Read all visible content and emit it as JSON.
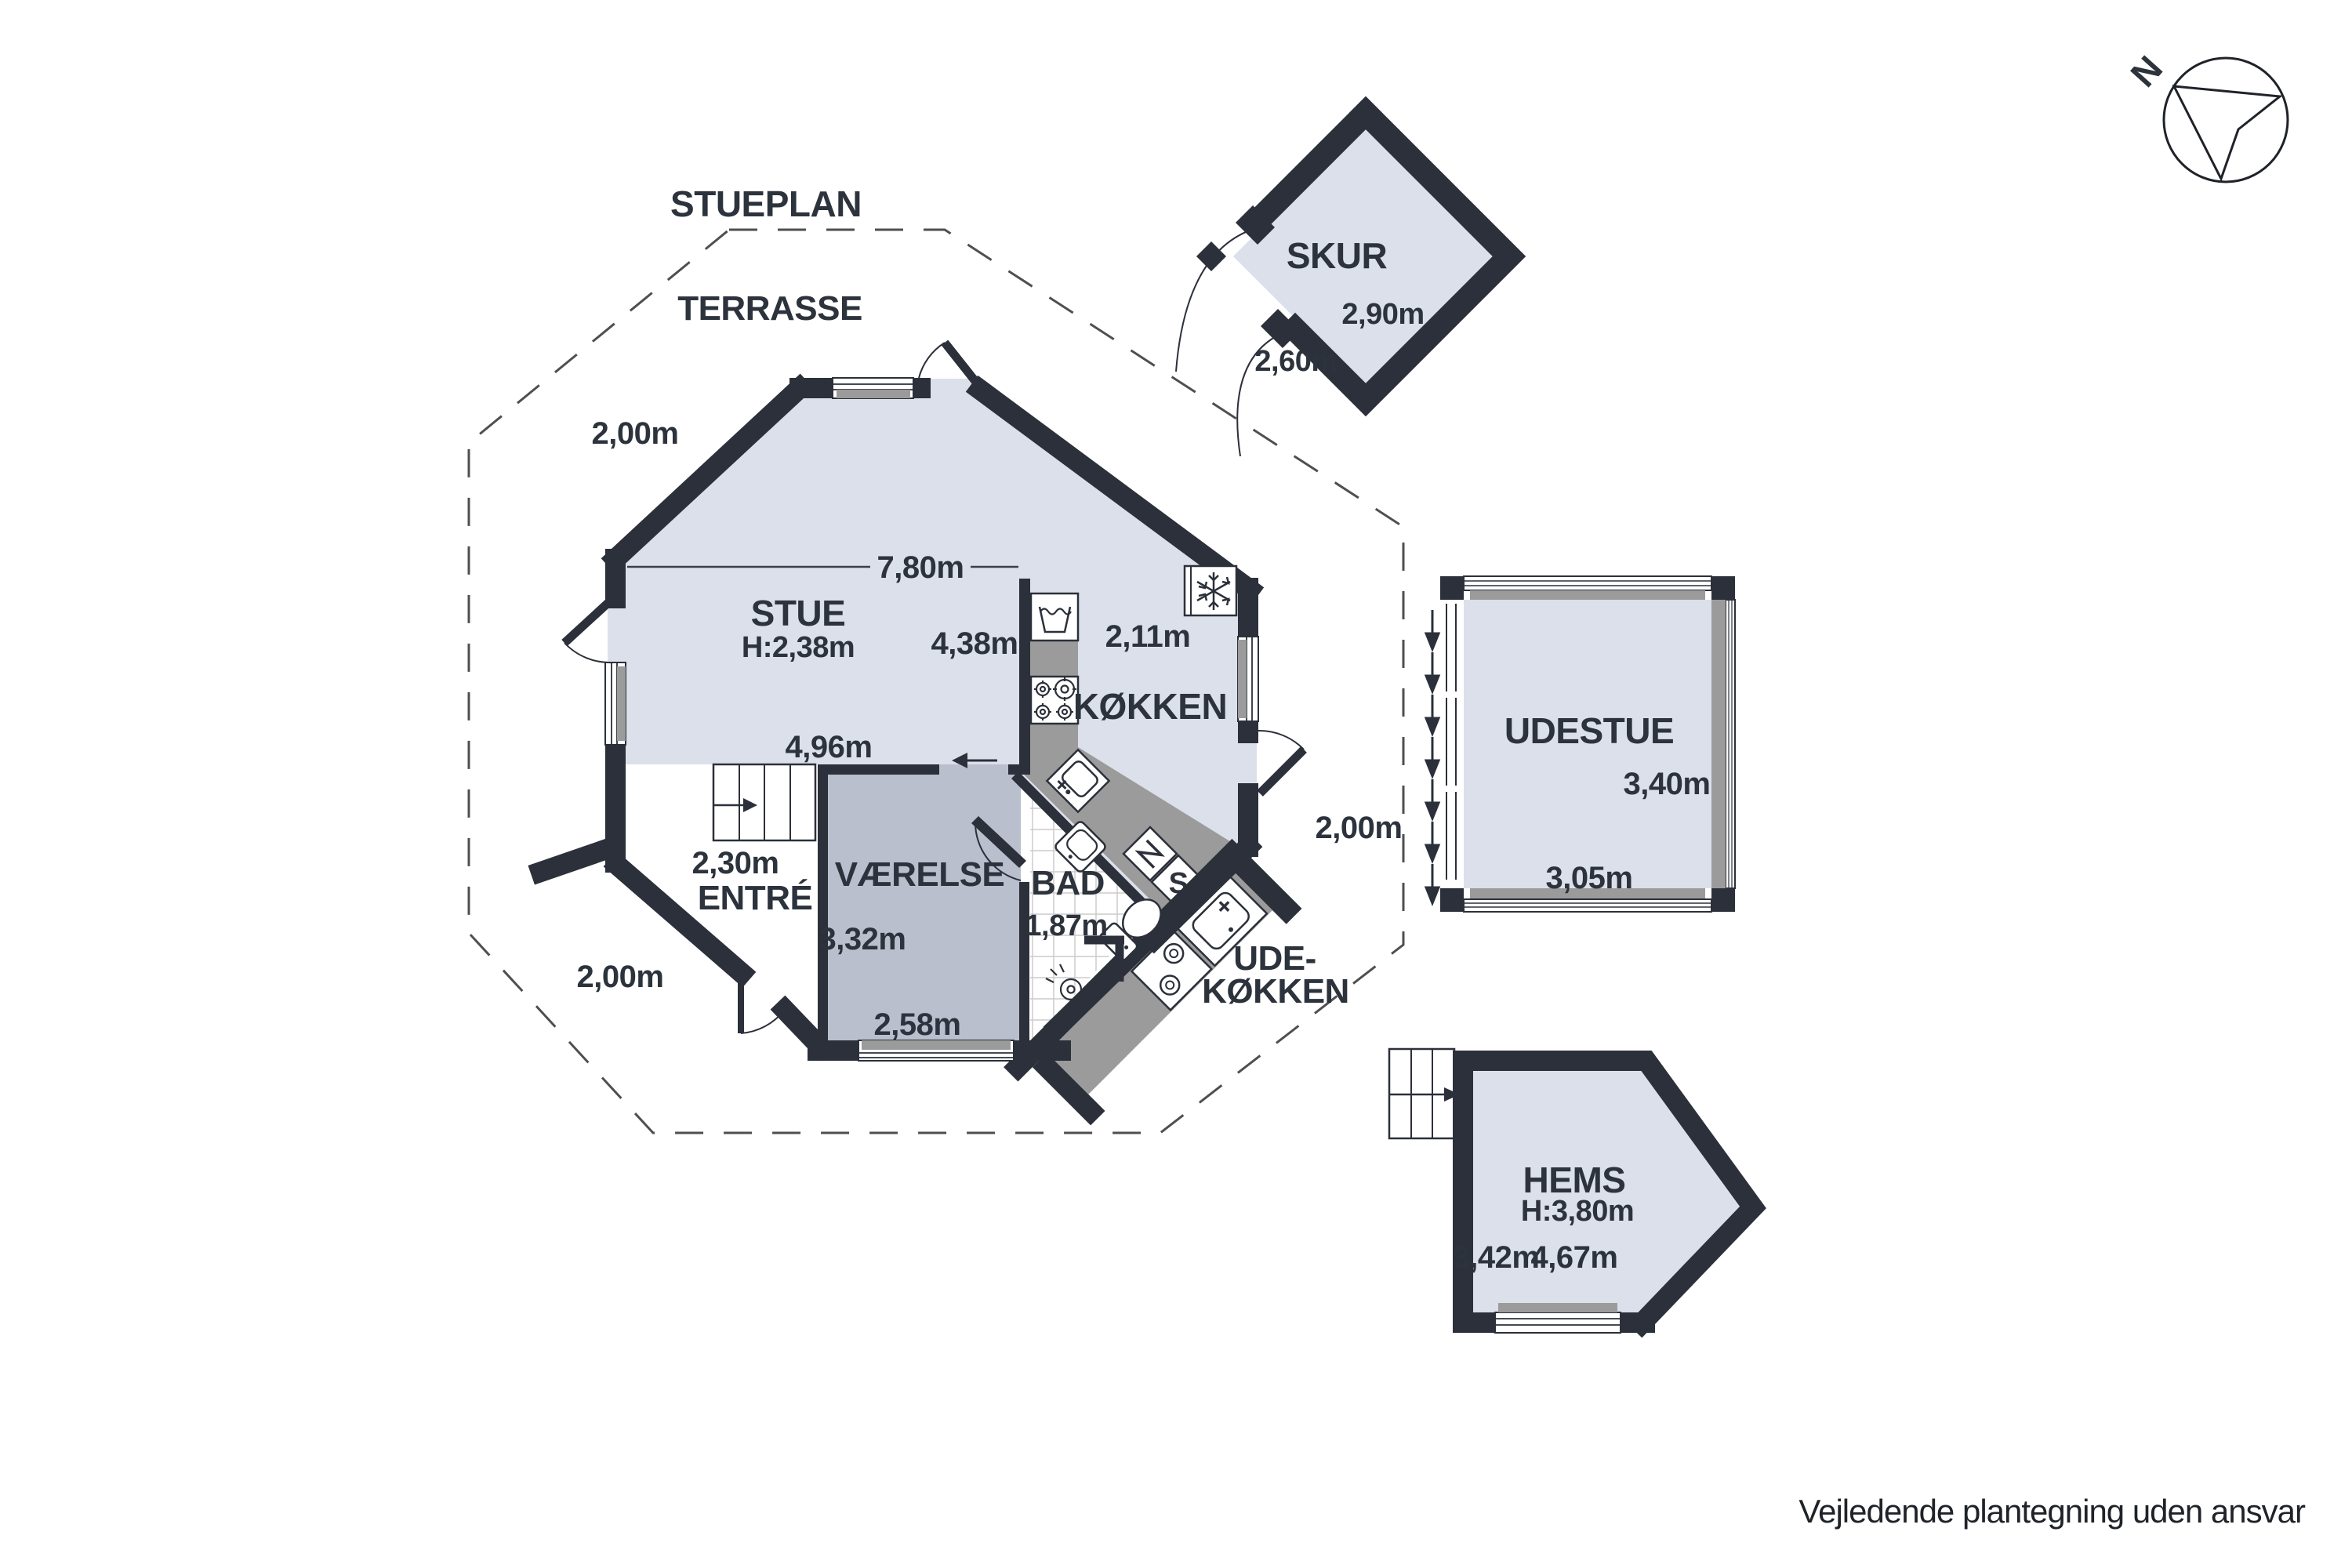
{
  "title": "STUEPLAN",
  "disclaimer": "Vejledende plantegning uden ansvar",
  "compass": {
    "north_label": "N"
  },
  "colors": {
    "wall": "#2b303a",
    "floor_light": "#dbe0ea",
    "floor_dark": "#b9bfcc",
    "counter_gray": "#9b9b9b",
    "tile_line": "#cccccc",
    "dash_line": "#4f4f4f"
  },
  "terrace": {
    "label": "TERRASSE",
    "clearance_nw": "2,00m",
    "clearance_sw": "2,00m",
    "clearance_e": "2,00m"
  },
  "main_floor": {
    "stue": {
      "name": "STUE",
      "ceiling_height": "H:2,38m",
      "width_total": "7,80m",
      "width_partial": "4,96m"
    },
    "koekken": {
      "name": "KØKKEN",
      "length": "4,38m",
      "width": "2,11m"
    },
    "vaerelse": {
      "name": "VÆRELSE",
      "length": "3,32m",
      "width": "2,58m"
    },
    "bad": {
      "name": "BAD",
      "width": "1,87m"
    },
    "entre": {
      "name": "ENTRÉ",
      "width": "2,30m"
    },
    "udekoekken": {
      "name_line1": "UDE-",
      "name_line2": "KØKKEN"
    },
    "closet_label": "S"
  },
  "outbuildings": {
    "skur": {
      "name": "SKUR",
      "width": "2,60m",
      "length": "2,90m"
    },
    "udestue": {
      "name": "UDESTUE",
      "length": "3,40m",
      "width": "3,05m"
    },
    "hems": {
      "name": "HEMS",
      "ceiling_height": "H:3,80m",
      "width": "3,42m",
      "length": "4,67m"
    }
  }
}
